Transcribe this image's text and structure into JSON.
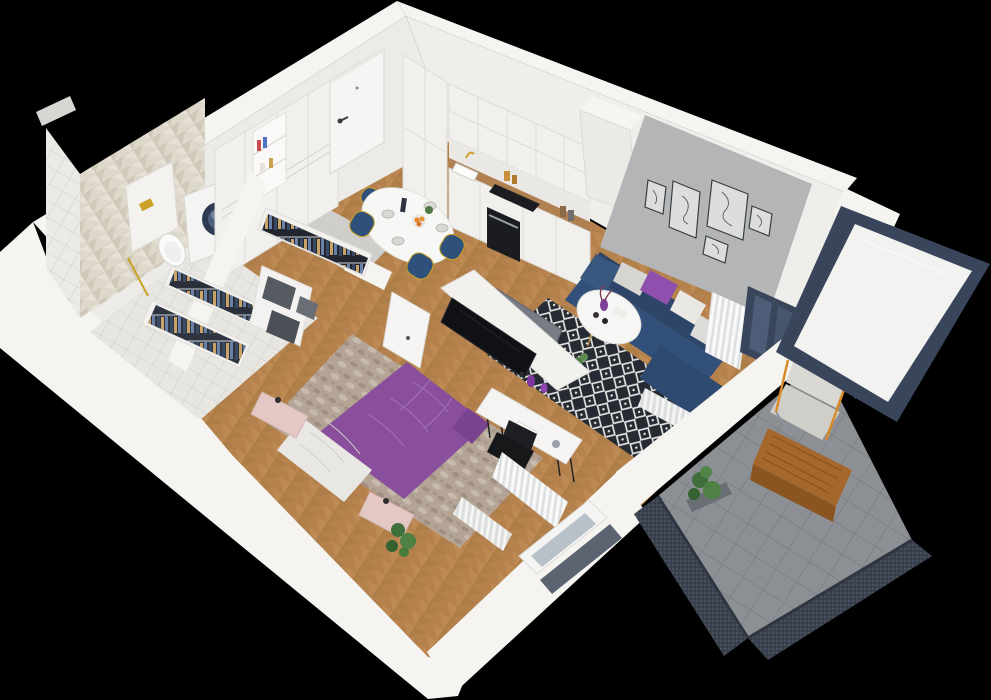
{
  "scene": {
    "description": "3D isometric floor-plan render of a studio apartment with balcony, viewed from above on a black background",
    "rooms": [
      {
        "name": "hallway",
        "items": [
          "entry-door",
          "built-in-wardrobe",
          "bookshelf-niche",
          "gray-tile-floor"
        ]
      },
      {
        "name": "bathroom",
        "items": [
          "herringbone-tile-wall",
          "square-tile-shower-wall",
          "wall-hung-toilet",
          "concealed-cistern-gold-flush",
          "washing-machine",
          "gold-towel-rail",
          "tile-floor"
        ]
      },
      {
        "name": "kitchen",
        "items": [
          "tall-cabinets",
          "upper-cabinets",
          "base-cabinets",
          "wood-countertop",
          "sink",
          "gold-faucet",
          "black-cooktop",
          "built-in-oven",
          "storage-jars",
          "marble-backsplash"
        ]
      },
      {
        "name": "dining-area",
        "items": [
          "white-round-table",
          "four-navy-gold-chairs",
          "plates",
          "fruit-bowl",
          "bottle",
          "small-plant"
        ]
      },
      {
        "name": "living-room",
        "items": [
          "navy-corner-sofa",
          "gray-purple-white-cushions",
          "white-round-coffee-table",
          "purple-vase-flowers",
          "black-white-diamond-rug",
          "gallery-wall-five-frames",
          "dark-balcony-door",
          "sheer-curtain",
          "radiator",
          "small-plant"
        ]
      },
      {
        "name": "walk-in-closet",
        "items": [
          "open-hanging-racks",
          "clothes-on-hangers",
          "gray-storage-boxes",
          "white-shelving",
          "open-white-door"
        ]
      },
      {
        "name": "bedroom",
        "items": [
          "double-bed-purple-duvet",
          "white-quilted-throw",
          "two-pink-nightstands",
          "black-table-lamps",
          "marbled-area-rug",
          "tv-partition-wall",
          "black-tv-screen",
          "gray-tv-back",
          "white-desk-console",
          "black-desk-chair",
          "purple-vases",
          "magazine",
          "potted-plant",
          "window-with-curtains",
          "radiator",
          "gray-window-sill-panel"
        ]
      },
      {
        "name": "balcony",
        "items": [
          "large-glazed-panel",
          "dark-mesh-railing",
          "gray-tile-floor",
          "outdoor-armchair-gray-cushions",
          "wooden-slat-coffee-table",
          "corner-potted-plant"
        ]
      }
    ],
    "wall_count_note": "white walls cut low on the viewer side, full height on the two far sides"
  },
  "palette": {
    "background": "#000000",
    "wall_top": "#f5f4f1",
    "wall_face": "#edebe7",
    "wall_face_ne": "#f0eeea",
    "wood_floor": "#b5824e",
    "hall_tile": "#cfcecb",
    "bath_tile": "#e8e6e1",
    "herringbone": "#ded8cb",
    "shower_tile": "#eceae6",
    "accent_wall": "#b3b5b6",
    "cabinet_white": "#f1f0ed",
    "counter_wood": "#b08051",
    "appliance_dark": "#1a1c20",
    "sofa_navy": "#32507a",
    "sofa_navy_dark": "#2c4568",
    "cushion_gray": "#d6d5d1",
    "cushion_purple": "#8e4fae",
    "cushion_white": "#e9e8e5",
    "bed_purple": "#8a4f9c",
    "blanket_white": "#e9e7e4",
    "nightstand_pink": "#e3c8c4",
    "rug_dark": "#262b33",
    "rug_marble": "#b3a496",
    "chair_navy": "#30507c",
    "gold": "#c9a227",
    "tv_black": "#101114",
    "tv_back_gray": "#787d85",
    "balcony_tile": "#8c9094",
    "railing_dark": "#3c4350",
    "frame_navy": "#39455a",
    "glass_white": "#f2f2f1",
    "glass_blue": "#b9c1c8",
    "window_sill_gray": "#5c6471",
    "table_wood": "#a5672c",
    "plant_green": "#4f8145",
    "door_white": "#f6f5f3",
    "curtain_white": "#f0f1f2",
    "drum_navy": "#2c3a52"
  }
}
